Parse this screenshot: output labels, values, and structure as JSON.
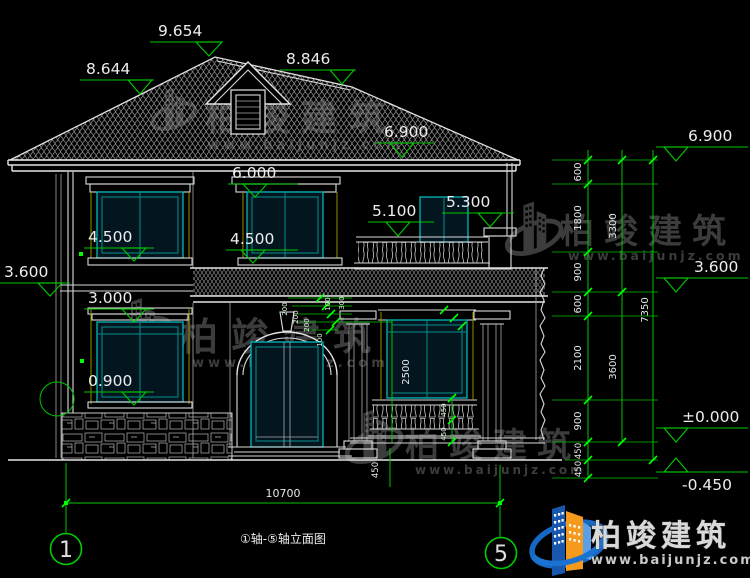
{
  "colors": {
    "background": "#000000",
    "line_white": "#d9d9d9",
    "dimension_green": "#00c400",
    "grip_green": "#00ff00",
    "window_cyan": "#00b8b8",
    "trim_yellow": "#8f8f00",
    "tile_gray": "#8f8f8f",
    "watermark_gray": "#3c3c3c",
    "logo_blue": "#1a5fb4",
    "logo_orange": "#f59a1d"
  },
  "levels": {
    "ridge": "9.654",
    "roof_left": "8.644",
    "roof_right": "8.846",
    "eave": "6.900",
    "win2_head": "6.000",
    "balcony_rail": "5.100",
    "balcony_pillar": "5.300",
    "win2_sill_left": "4.500",
    "win2_sill_center": "4.500",
    "floor2": "3.600",
    "win1_head": "3.000",
    "win1_sill": "0.900"
  },
  "right_levels": {
    "eave": "6.900",
    "floor2": "3.600",
    "zero": "±0.000",
    "ground": "-0.450"
  },
  "dims": {
    "right_chain": [
      "600",
      "1800",
      "900",
      "600",
      "2100",
      "900",
      "450",
      "450"
    ],
    "right_totals": [
      "3300",
      "3600"
    ],
    "right_overall": "7350",
    "bottom_overall": "10700",
    "inner": {
      "a": "200",
      "b": "200",
      "c": "200",
      "d": "100",
      "e": "100",
      "f": "300",
      "g": "2500",
      "h": "450",
      "i": "450",
      "j": "450"
    }
  },
  "axes": {
    "left": "1",
    "right": "5"
  },
  "title": {
    "text": "①轴-⑤轴立面图"
  },
  "watermark": {
    "brand": "柏竣建筑",
    "site": "www.baijunjz.com"
  },
  "brand": {
    "name": "柏竣建筑",
    "site": "www.baijunjz.com"
  }
}
